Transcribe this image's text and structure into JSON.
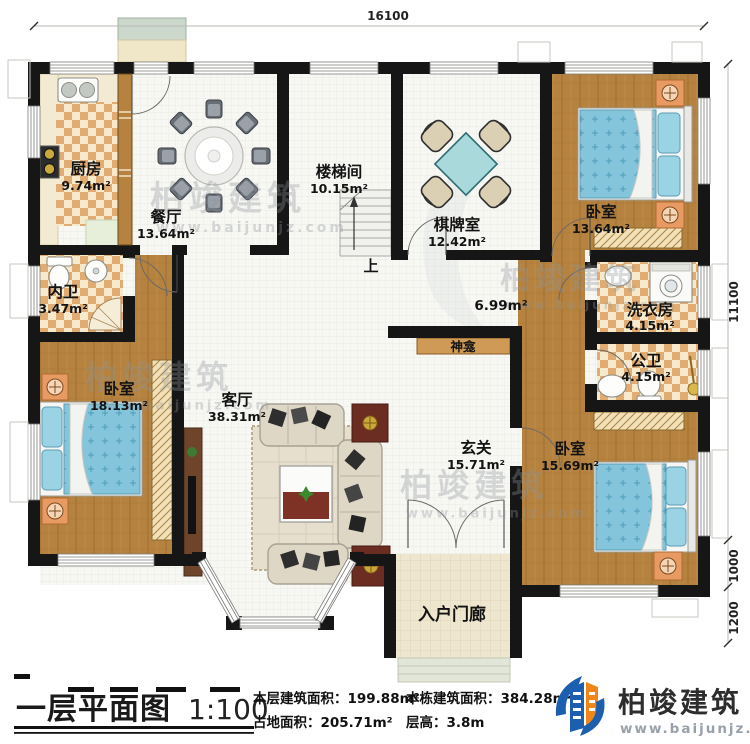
{
  "plan": {
    "rooms": [
      {
        "name": "厨房",
        "area": "9.74m²"
      },
      {
        "name": "餐厅",
        "area": "13.64m²"
      },
      {
        "name": "楼梯间",
        "area": "10.15m²"
      },
      {
        "name": "棋牌室",
        "area": "12.42m²"
      },
      {
        "name": "卧室",
        "area": "13.64m²"
      },
      {
        "name": "内卫",
        "area": "3.47m²"
      },
      {
        "name": "洗衣房",
        "area": "4.15m²"
      },
      {
        "name": "公卫",
        "area": "4.15m²"
      },
      {
        "name": "卧室",
        "area": "18.13m²"
      },
      {
        "name": "客厅",
        "area": "38.31m²"
      },
      {
        "name": "玄关",
        "area": "15.71m²"
      },
      {
        "name": "卧室",
        "area": "15.69m²"
      }
    ],
    "labels": {
      "corridor_area": "6.99m²",
      "shrine": "神龛",
      "stairs_up": "上",
      "porch": "入户门廊"
    },
    "dimensions": {
      "top": "16100",
      "right": "11100",
      "right_step": "1000",
      "right_porch": "1200"
    }
  },
  "watermark": {
    "brand": "柏竣建筑",
    "url": "www.baijunjz.com"
  },
  "footer": {
    "title": "一层平面图",
    "scale": "1:100",
    "stats": [
      {
        "text": "本层建筑面积：199.88m²"
      },
      {
        "text": "占地面积：205.71m²"
      },
      {
        "text": "本栋建筑面积：384.28m²"
      },
      {
        "text": "层高：3.8m"
      }
    ],
    "logo": {
      "brand": "柏竣建筑",
      "url": "www.baijunjz.com"
    }
  },
  "colors": {
    "wall": "#161616",
    "wood": "#b5823f",
    "checker": "#e2b277",
    "tile": "#f7f7f4",
    "bed": "#84c5dc",
    "accent_blue": "#1b5fae",
    "accent_orange": "#f08519"
  }
}
